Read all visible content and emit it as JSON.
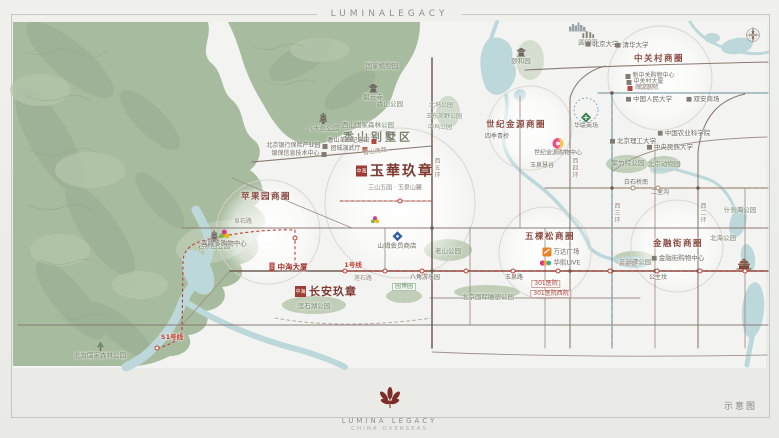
{
  "header": {
    "brand": "LUMINALEGACY"
  },
  "footer": {
    "brand": "LUMINA LEGACY",
    "sub": "CHINA OVERSEAS",
    "note": "示意图"
  },
  "colors": {
    "accent_red": "#c23b32",
    "seal_red": "#9e3b32",
    "mountain": "#a7bb9e",
    "water": "#bdd8da",
    "park": "#bccbb3",
    "road": "#8a7a72",
    "metro_blue": "#74a8c4",
    "metro_brown": "#a4876f",
    "district_text": "#8a4a40"
  },
  "map": {
    "projects": [
      {
        "seal": "中海",
        "t": "玉華玖章",
        "cap": "三山五园 · 玉泉山麓",
        "x": 395,
        "y": 176,
        "big": true,
        "name": "project-yuhua-jiuzhang"
      },
      {
        "seal": "中海",
        "t": "长安玖章",
        "cap": "",
        "x": 326,
        "y": 291,
        "big": false,
        "name": "project-changan-jiuzhang"
      }
    ],
    "labels": [
      {
        "t": "苹果园商圈",
        "x": 266,
        "y": 197,
        "cls": "district",
        "name": "district-pingguoyuan"
      },
      {
        "t": "五棵松商圈",
        "x": 550,
        "y": 237,
        "cls": "district",
        "name": "district-wukesong"
      },
      {
        "t": "世纪金源商圈",
        "x": 516,
        "y": 125,
        "cls": "district",
        "name": "district-shijijinyuan"
      },
      {
        "t": "中关村商圈",
        "x": 659,
        "y": 59,
        "cls": "district",
        "name": "district-zhongguancun"
      },
      {
        "t": "金融街商圈",
        "x": 678,
        "y": 244,
        "cls": "district",
        "name": "district-jinrongjie"
      },
      {
        "t": "香山别墅区",
        "x": 378,
        "y": 137,
        "cls": "area",
        "name": "area-xiangshan-villa"
      },
      {
        "t": "八大处公园",
        "x": 323,
        "y": 122,
        "cls": "park",
        "icon": "pagoda",
        "ipos": "top",
        "name": "park-badachu"
      },
      {
        "t": "西山国家森林公园",
        "x": 368,
        "y": 125,
        "cls": "park",
        "name": "park-xishan-forest"
      },
      {
        "t": "香山公园",
        "x": 390,
        "y": 104,
        "cls": "park",
        "name": "park-xiangshan"
      },
      {
        "t": "国家植物园",
        "x": 382,
        "y": 66,
        "cls": "park",
        "name": "park-botanical-garden"
      },
      {
        "t": "碧云寺",
        "x": 373,
        "y": 92,
        "cls": "park",
        "icon": "temple",
        "ipos": "top",
        "name": "temple-biyunsi"
      },
      {
        "t": "北宫国家森林公园",
        "x": 100,
        "y": 350,
        "cls": "park",
        "icon": "tree",
        "ipos": "top",
        "name": "park-beigong-forest"
      },
      {
        "t": "石景山公园",
        "x": 214,
        "y": 240,
        "cls": "park",
        "icon": "pagoda",
        "ipos": "top",
        "name": "park-shijingshan"
      },
      {
        "t": "莲石湖公园",
        "x": 314,
        "y": 306,
        "cls": "park",
        "name": "park-lianshihu"
      },
      {
        "t": "老山公园",
        "x": 448,
        "y": 251,
        "cls": "park",
        "name": "park-laoshan"
      },
      {
        "t": "北京国际雕塑公园",
        "x": 488,
        "y": 297,
        "cls": "park",
        "name": "park-sculpture"
      },
      {
        "t": "紫竹院公园",
        "x": 628,
        "y": 163,
        "cls": "park",
        "name": "park-zizhuyuan"
      },
      {
        "t": "北京动物园",
        "x": 664,
        "y": 164,
        "cls": "park",
        "name": "park-beijing-zoo"
      },
      {
        "t": "玉渊潭公园",
        "x": 635,
        "y": 262,
        "cls": "park",
        "name": "park-yuyuantan"
      },
      {
        "t": "什刹海公园",
        "x": 740,
        "y": 210,
        "cls": "park",
        "name": "park-shichahai"
      },
      {
        "t": "北海公园",
        "x": 723,
        "y": 238,
        "cls": "park",
        "name": "park-beihai"
      },
      {
        "t": "北坞公园",
        "x": 441,
        "y": 106,
        "cls": "park-s",
        "name": "park-beiwu"
      },
      {
        "t": "玉东郊野公园",
        "x": 444,
        "y": 117,
        "cls": "park-s",
        "name": "park-yudong"
      },
      {
        "t": "中坞公园",
        "x": 440,
        "y": 128,
        "cls": "park-s",
        "name": "park-zhongwu"
      },
      {
        "t": "颐和园",
        "x": 521,
        "y": 56,
        "cls": "park",
        "icon": "temple",
        "ipos": "top",
        "name": "park-summer-palace"
      },
      {
        "t": "圆明园",
        "x": 588,
        "y": 38,
        "cls": "park",
        "icon": "ruins",
        "ipos": "top",
        "name": "park-yuanmingyuan"
      },
      {
        "t": "园博园",
        "x": 404,
        "y": 287,
        "cls": "tag-green",
        "name": "park-yuanboyuan"
      },
      {
        "t": "北京银行保险产业园",
        "x": 297,
        "y": 146,
        "cls": "poi-s",
        "icon": "sq",
        "ipos": "right",
        "name": "poi-bank-insurance-park"
      },
      {
        "t": "银保信息技术中心",
        "x": 299,
        "y": 154,
        "cls": "poi-s",
        "icon": "sq",
        "ipos": "right",
        "name": "poi-yinbao-it-center"
      },
      {
        "t": "香山革命纪念馆",
        "x": 352,
        "y": 141,
        "cls": "poi-s",
        "icon": "sq-red",
        "ipos": "right",
        "name": "poi-xiangshan-memorial"
      },
      {
        "t": "团城演武厅",
        "x": 349,
        "y": 149,
        "cls": "poi-s",
        "icon": "sq-red",
        "ipos": "right",
        "name": "poi-tuancheng"
      },
      {
        "t": "北京大学",
        "x": 602,
        "y": 44,
        "cls": "poi",
        "icon": "sq",
        "name": "poi-peking-university"
      },
      {
        "t": "清华大学",
        "x": 632,
        "y": 45,
        "cls": "poi",
        "icon": "sq",
        "name": "poi-tsinghua-university"
      },
      {
        "t": "新中关购物中心",
        "x": 650,
        "y": 76,
        "cls": "poi-s",
        "icon": "sq",
        "name": "poi-xinzhongguan"
      },
      {
        "t": "中关村大厦",
        "x": 645,
        "y": 82,
        "cls": "poi-s",
        "icon": "sq",
        "name": "poi-zhongguancun-tower"
      },
      {
        "t": "海淀医院",
        "x": 643,
        "y": 88,
        "cls": "poi-s",
        "icon": "sq-red",
        "name": "poi-haidian-hospital"
      },
      {
        "t": "中国人民大学",
        "x": 649,
        "y": 99,
        "cls": "poi",
        "icon": "sq",
        "name": "poi-renmin-university"
      },
      {
        "t": "双安商场",
        "x": 703,
        "y": 99,
        "cls": "poi",
        "icon": "sq",
        "name": "poi-shuangan-mall"
      },
      {
        "t": "北京理工大学",
        "x": 633,
        "y": 141,
        "cls": "poi",
        "icon": "sq",
        "name": "poi-bit-university"
      },
      {
        "t": "中国农业科学院",
        "x": 684,
        "y": 133,
        "cls": "poi",
        "icon": "sq",
        "name": "poi-caas"
      },
      {
        "t": "中央民族大学",
        "x": 670,
        "y": 147,
        "cls": "poi",
        "icon": "sq",
        "name": "poi-minzu-university"
      },
      {
        "t": "金融街购物中心",
        "x": 678,
        "y": 258,
        "cls": "poi",
        "icon": "sq",
        "name": "poi-jinrongjie-mall"
      },
      {
        "t": "四季青桥",
        "x": 497,
        "y": 137,
        "cls": "poi-s",
        "name": "poi-sijiqing-bridge"
      },
      {
        "t": "玉泉慧谷",
        "x": 542,
        "y": 166,
        "cls": "poi-s",
        "name": "poi-yuquan-huigu"
      },
      {
        "t": "山姆会员商店",
        "x": 397,
        "y": 240,
        "cls": "poi",
        "icon": "diamond-blue",
        "ipos": "top",
        "name": "poi-sams-club"
      },
      {
        "t": "喜隆多购物中心",
        "x": 224,
        "y": 238,
        "cls": "poi",
        "icon": "flower",
        "ipos": "top",
        "name": "poi-xilongduo"
      },
      {
        "t": "万达广场",
        "x": 561,
        "y": 252,
        "cls": "poi",
        "icon": "wanda",
        "name": "poi-wanda-plaza"
      },
      {
        "t": "华熙LIVE",
        "x": 560,
        "y": 263,
        "cls": "poi",
        "icon": "huaxi",
        "name": "poi-huaxi-live"
      },
      {
        "t": "世纪金源购物中心",
        "x": 558,
        "y": 147,
        "cls": "poi-s",
        "icon": "jinyuan",
        "ipos": "top",
        "name": "poi-jinyuan-shopping-mall"
      },
      {
        "t": "华联商场",
        "x": 586,
        "y": 121,
        "cls": "poi-s",
        "icon": "diamond-green",
        "ipos": "top",
        "name": "poi-hualian-mall"
      },
      {
        "t": "中海大厦",
        "x": 288,
        "y": 267,
        "cls": "redbold",
        "icon": "building-red",
        "name": "poi-zhonghai-tower"
      },
      {
        "t": "301医院",
        "x": 546,
        "y": 284,
        "cls": "tag-red",
        "name": "poi-301-hospital"
      },
      {
        "t": "301医院西院",
        "x": 551,
        "y": 294,
        "cls": "tag-red",
        "name": "poi-301-hospital-west"
      },
      {
        "t": "1号线",
        "x": 353,
        "y": 265,
        "cls": "metro-red",
        "name": "label-metro-line1"
      },
      {
        "t": "S1号线",
        "x": 172,
        "y": 337,
        "cls": "metro-red",
        "name": "label-metro-lineS1"
      },
      {
        "t": "八角游乐园",
        "x": 425,
        "y": 278,
        "cls": "station",
        "name": "station-bajiao"
      },
      {
        "t": "玉泉路",
        "x": 514,
        "y": 278,
        "cls": "station",
        "name": "station-yuquanlu"
      },
      {
        "t": "公主坟",
        "x": 658,
        "y": 278,
        "cls": "station",
        "name": "station-gongzhufen"
      },
      {
        "t": "白石桥南",
        "x": 636,
        "y": 183,
        "cls": "station",
        "name": "station-baishiqiaonan"
      },
      {
        "t": "二里沟",
        "x": 660,
        "y": 193,
        "cls": "station",
        "name": "station-erligou"
      },
      {
        "t": "阜石路",
        "x": 243,
        "y": 222,
        "cls": "road",
        "name": "road-fushilu"
      },
      {
        "t": "莲石路",
        "x": 363,
        "y": 279,
        "cls": "road",
        "name": "road-lianshilu"
      },
      {
        "t": "香山南路",
        "x": 375,
        "y": 152,
        "cls": "road",
        "rot": -8,
        "name": "road-xiangshannanlu"
      },
      {
        "t": "长安街",
        "x": 628,
        "y": 265,
        "cls": "road",
        "name": "road-changanjie"
      },
      {
        "t": "北四环",
        "x": 646,
        "y": 88,
        "cls": "road",
        "name": "road-beisihuan"
      },
      {
        "t": "西五环",
        "x": 436,
        "y": 168,
        "cls": "road-v",
        "name": "road-xiwuhuan"
      },
      {
        "t": "西四环",
        "x": 574,
        "y": 168,
        "cls": "road-v",
        "name": "road-xisihuan"
      },
      {
        "t": "西三环",
        "x": 616,
        "y": 213,
        "cls": "road-v",
        "name": "road-xisanhuan"
      },
      {
        "t": "西二环",
        "x": 702,
        "y": 213,
        "cls": "road-v",
        "name": "road-xierhuan"
      },
      {
        "t": "",
        "icon": "compass",
        "x": 753,
        "y": 35,
        "cls": "iconly",
        "name": "compass-rose"
      },
      {
        "t": "",
        "icon": "skyline",
        "x": 578,
        "y": 27,
        "cls": "iconly",
        "name": "city-skyline"
      },
      {
        "t": "",
        "icon": "palace",
        "x": 744,
        "y": 264,
        "cls": "iconly",
        "name": "forbidden-city"
      },
      {
        "t": "",
        "icon": "flower2",
        "x": 375,
        "y": 220,
        "cls": "iconly",
        "name": "shougang-mark"
      }
    ],
    "stations": [
      {
        "x": 345,
        "y": 271,
        "line": "1"
      },
      {
        "x": 385,
        "y": 271,
        "line": "1"
      },
      {
        "x": 422,
        "y": 271,
        "line": "1"
      },
      {
        "x": 466,
        "y": 271,
        "line": "1"
      },
      {
        "x": 513,
        "y": 271,
        "line": "1"
      },
      {
        "x": 558,
        "y": 271,
        "line": "1"
      },
      {
        "x": 610,
        "y": 271,
        "line": "1"
      },
      {
        "x": 657,
        "y": 271,
        "line": "1"
      },
      {
        "x": 700,
        "y": 271,
        "line": "1"
      },
      {
        "x": 745,
        "y": 271,
        "line": "1"
      },
      {
        "x": 400,
        "y": 201,
        "line": "1"
      },
      {
        "x": 157,
        "y": 348,
        "line": "s1"
      },
      {
        "x": 295,
        "y": 238,
        "line": "s1"
      },
      {
        "x": 633,
        "y": 188,
        "line": "6"
      },
      {
        "x": 658,
        "y": 188,
        "line": "6"
      }
    ]
  }
}
